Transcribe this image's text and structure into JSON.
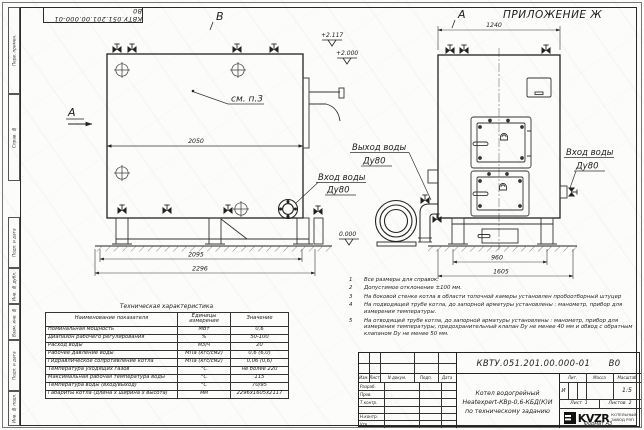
{
  "sheet": {
    "appendix": "ПРИЛОЖЕНИЕ Ж",
    "view_a": "А",
    "view_b": "В",
    "section_a": "А",
    "doc_number_rotated": "КВТУ.051.201.00.000-01 В0",
    "format_label": "Формат А3"
  },
  "frame_strip": [
    "Перв. примен.",
    "Справ. №",
    "Подп. и дата",
    "Инв. № дубл.",
    "Взам. инв. №",
    "Подп. и дата",
    "Инв. № подл."
  ],
  "drawing": {
    "callout_see": "см. п.3",
    "dim_body_length": "2050",
    "dim_outer_length1": "2095",
    "dim_outer_length2": "2296",
    "dim_front_width_top": "1240",
    "dim_front_width1": "960",
    "dim_front_width2": "1605",
    "elev_top1": "+2.117",
    "elev_top2": "+2.000",
    "elev_zero": "0.000",
    "outlet_label_line1": "Выход воды",
    "outlet_label_line2": "Ду80",
    "inlet_left_line1": "Вход воды",
    "inlet_left_line2": "Ду80",
    "inlet_right_line1": "Вход воды",
    "inlet_right_line2": "Ду80"
  },
  "tech_table": {
    "title": "Техническая характеристика",
    "headers": [
      "Наименование показателя",
      "Единицы измерения",
      "Значение"
    ],
    "rows": [
      [
        "Номинальная мощность",
        "МВт",
        "0,6"
      ],
      [
        "Диапазон рабочего регулирования",
        "%",
        "50-100"
      ],
      [
        "Расход воды",
        "м3/ч",
        "20"
      ],
      [
        "Рабочее давление воды",
        "МПа (кгс/см2)",
        "0,6 (6,0)"
      ],
      [
        "Гидравлическое сопротивление котла",
        "МПа (кгс/см2)",
        "0,06 (0,6)"
      ],
      [
        "Температура уходящих газов",
        "°С",
        "не более 220"
      ],
      [
        "Максимальная рабочая температура воды",
        "°С",
        "115"
      ],
      [
        "Температура воды (вход/выход)",
        "°С",
        "70/95"
      ],
      [
        "Габариты котла (длина х ширина х высота)",
        "мм",
        "2296х1605х2117"
      ]
    ]
  },
  "notes": [
    {
      "num": "1",
      "text": "Все размеры для справок."
    },
    {
      "num": "2",
      "text": "Допустимое отклонение ±100 мм."
    },
    {
      "num": "3",
      "text": "На боковой стенке котла в области топочной камеры установлен пробоотборный штуцер"
    },
    {
      "num": "4",
      "text": "На  подводящей трубе котла, до запорной арматуры установлены : манометр, прибор для измерения температуры."
    },
    {
      "num": "5",
      "text": "На отводящей трубе котла, до запорной арматуры установлены : манометр, прибор для измерения температуры, предохранительный клапан Dу не менее 40 мм и обвод с обратным клапаном Dу не менее 50 мм."
    }
  ],
  "title_block": {
    "doc_number": "КВТУ.051.201.00.000-01",
    "doc_version": "В0",
    "name_line1": "Котел водогрейный",
    "name_line2": "Heatexpert-КВр-0,6-КБД(К)И",
    "name_line3": "по техническому заданию",
    "sig_headers": [
      "Изм.",
      "Лист",
      "N докум.",
      "Подп.",
      "Дата"
    ],
    "sig_rows": [
      "Разраб.",
      "Пров.",
      "Т.контр.",
      "",
      "Н.контр.",
      "Утв."
    ],
    "lit_header": "Лит.",
    "mass_header": "Масса",
    "scale_header": "Масштаб",
    "lit_value": "И",
    "scale_value": "1:5",
    "sheet_cell": "Лист  1",
    "sheets_cell": "Листов  2",
    "logo_text": "KVZR",
    "logo_sub1": "КОТЕЛЬНЫЙ",
    "logo_sub2": "ЗАВОД РЭП"
  }
}
